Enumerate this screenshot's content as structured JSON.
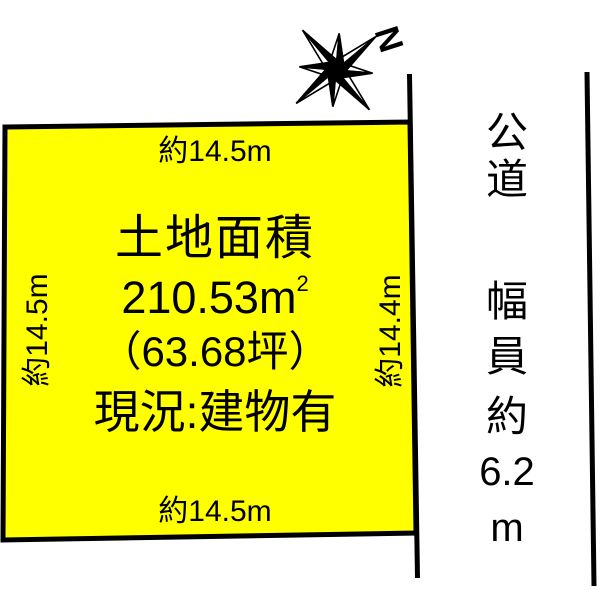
{
  "colors": {
    "plot_fill": "#ffff00",
    "line_color": "#000000",
    "background": "#ffffff"
  },
  "compass": {
    "north_label": "N"
  },
  "plot": {
    "top_label": "約14.5m",
    "left_label": "約14.5m",
    "right_label": "約14.4m",
    "bottom_label": "約14.5m",
    "area_title": "土地面積",
    "area_value": "210.53m",
    "area_value_sup": "2",
    "area_tsubo": "（63.68坪）",
    "status": "現況:建物有"
  },
  "road": {
    "chars": [
      "公",
      "道",
      "幅",
      "員",
      "約",
      "6.2",
      "m"
    ]
  }
}
